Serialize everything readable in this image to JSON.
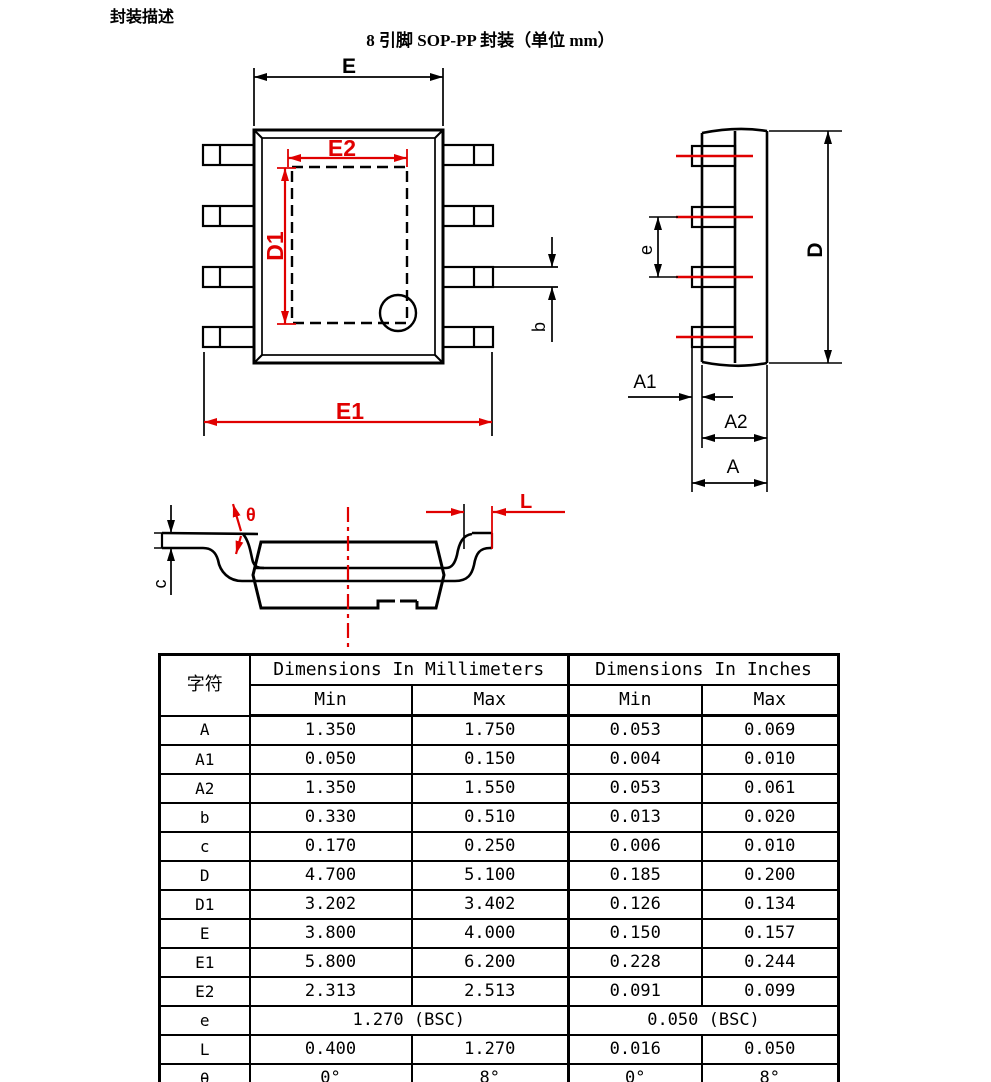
{
  "page": {
    "title": "封装描述",
    "subtitle": "8 引脚 SOP-PP 封装（单位 mm）"
  },
  "colors": {
    "dimension_red": "#e00000",
    "line_black": "#000000"
  },
  "drawings": {
    "top_view": {
      "labels": {
        "E": "E",
        "E2": "E2",
        "D1": "D1",
        "E1": "E1",
        "b": "b"
      }
    },
    "side_view": {
      "labels": {
        "e": "e",
        "D": "D",
        "A1": "A1",
        "A2": "A2",
        "A": "A"
      }
    },
    "front_view": {
      "labels": {
        "theta": "θ",
        "c": "c",
        "L": "L"
      }
    }
  },
  "table": {
    "col1_header": "字符",
    "group_headers": [
      "Dimensions In Millimeters",
      "Dimensions In Inches"
    ],
    "sub_headers": [
      "Min",
      "Max",
      "Min",
      "Max"
    ],
    "rows": [
      {
        "sym": "A",
        "mm_min": "1.350",
        "mm_max": "1.750",
        "in_min": "0.053",
        "in_max": "0.069"
      },
      {
        "sym": "A1",
        "mm_min": "0.050",
        "mm_max": "0.150",
        "in_min": "0.004",
        "in_max": "0.010"
      },
      {
        "sym": "A2",
        "mm_min": "1.350",
        "mm_max": "1.550",
        "in_min": "0.053",
        "in_max": "0.061"
      },
      {
        "sym": "b",
        "mm_min": "0.330",
        "mm_max": "0.510",
        "in_min": "0.013",
        "in_max": "0.020"
      },
      {
        "sym": "c",
        "mm_min": "0.170",
        "mm_max": "0.250",
        "in_min": "0.006",
        "in_max": "0.010"
      },
      {
        "sym": "D",
        "mm_min": "4.700",
        "mm_max": "5.100",
        "in_min": "0.185",
        "in_max": "0.200"
      },
      {
        "sym": "D1",
        "mm_min": "3.202",
        "mm_max": "3.402",
        "in_min": "0.126",
        "in_max": "0.134"
      },
      {
        "sym": "E",
        "mm_min": "3.800",
        "mm_max": "4.000",
        "in_min": "0.150",
        "in_max": "0.157"
      },
      {
        "sym": "E1",
        "mm_min": "5.800",
        "mm_max": "6.200",
        "in_min": "0.228",
        "in_max": "0.244"
      },
      {
        "sym": "E2",
        "mm_min": "2.313",
        "mm_max": "2.513",
        "in_min": "0.091",
        "in_max": "0.099"
      },
      {
        "sym": "e",
        "mm_span": "1.270 (BSC)",
        "in_span": "0.050 (BSC)"
      },
      {
        "sym": "L",
        "mm_min": "0.400",
        "mm_max": "1.270",
        "in_min": "0.016",
        "in_max": "0.050"
      },
      {
        "sym": "θ",
        "mm_min": "0°",
        "mm_max": "8°",
        "in_min": "0°",
        "in_max": "8°"
      }
    ]
  }
}
